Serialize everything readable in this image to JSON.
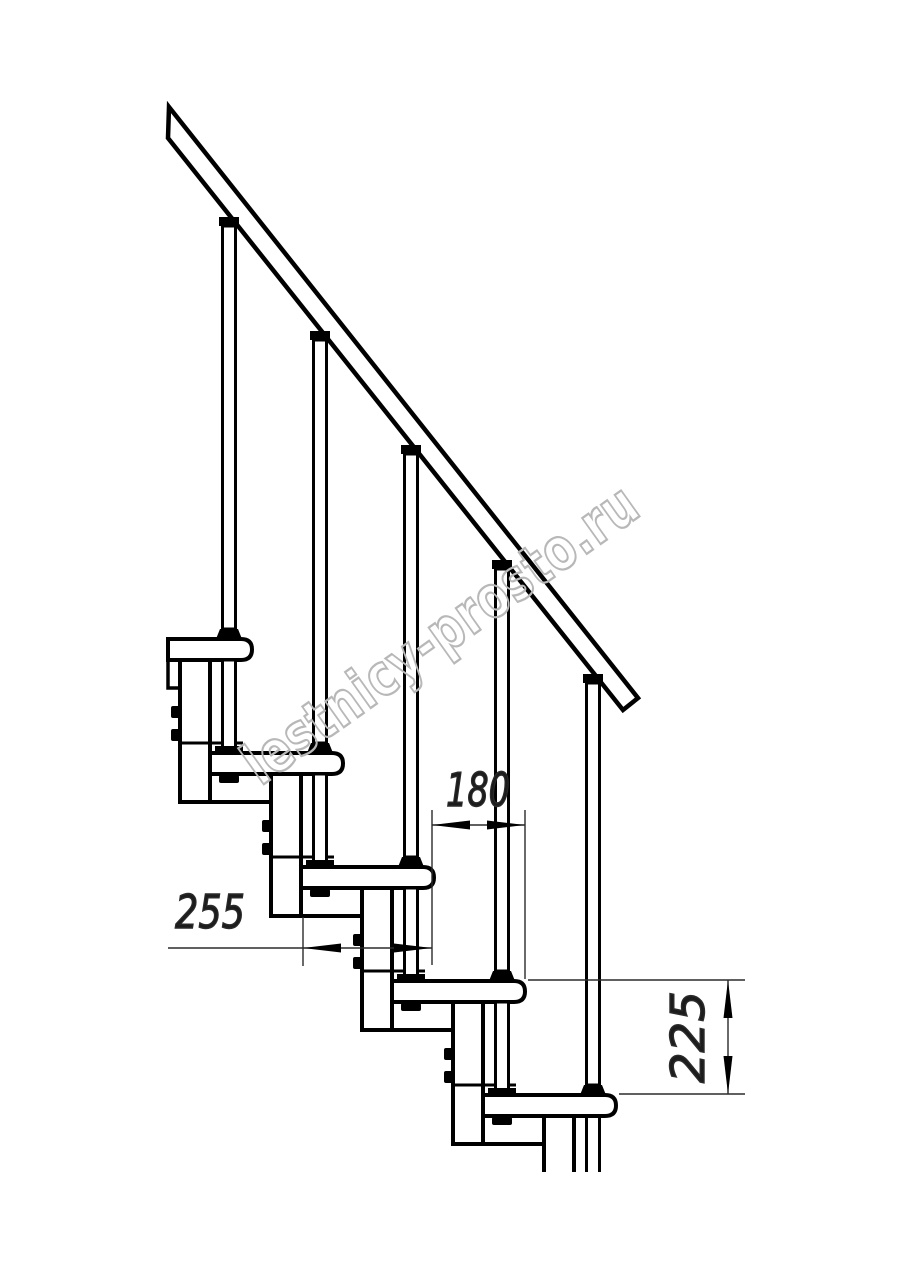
{
  "dimensions": {
    "run_255": "255",
    "overlap_180": "180",
    "rise_225": "225"
  },
  "watermark": "lestnicy-prosto.ru",
  "colors": {
    "line": "#000000",
    "background": "#ffffff",
    "dimension": "#2b2b2b",
    "watermark_outline": "#b8b8b8"
  }
}
